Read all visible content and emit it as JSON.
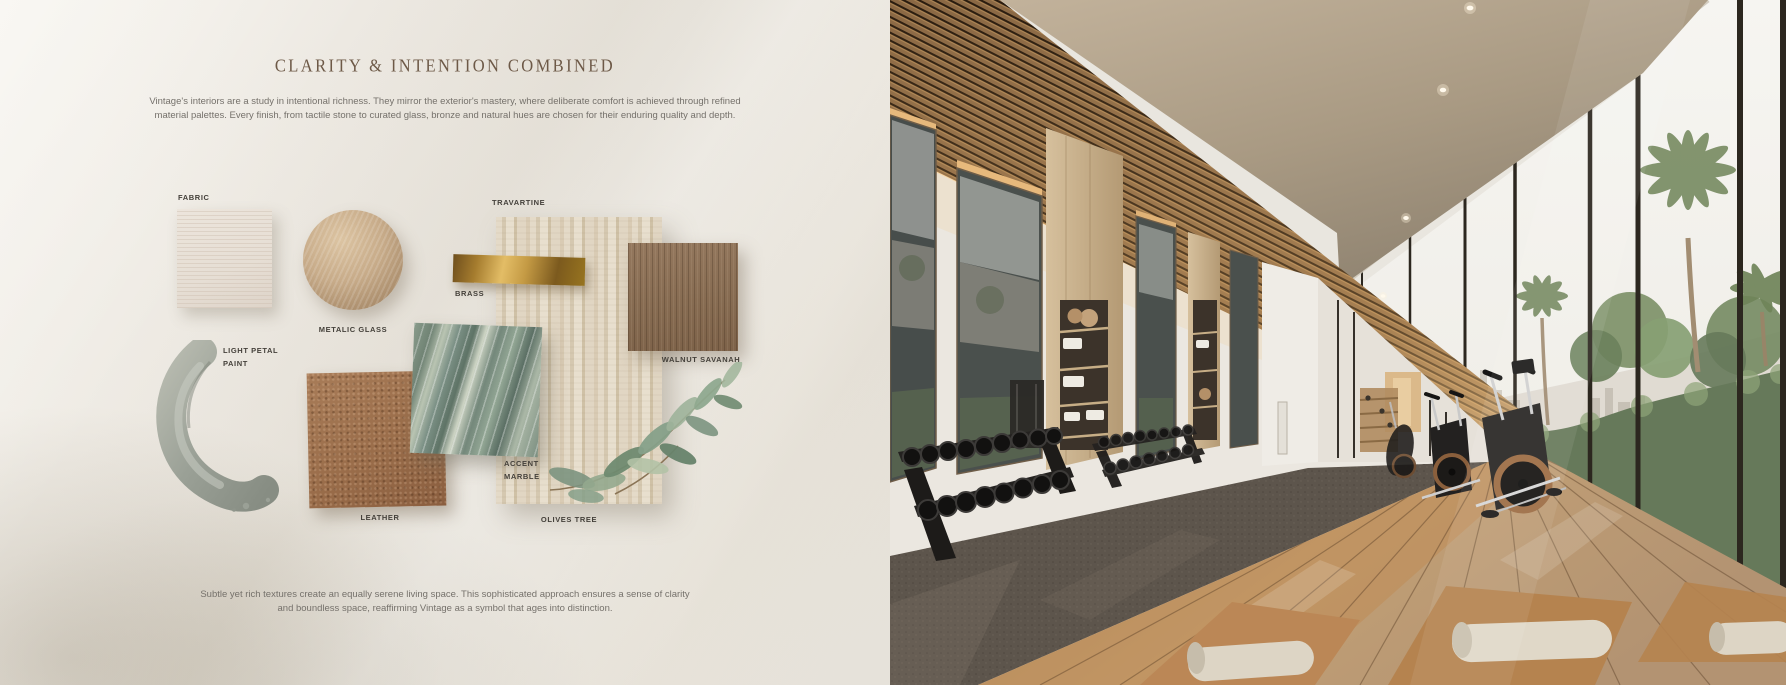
{
  "board": {
    "title": "CLARITY & INTENTION COMBINED",
    "intro": "Vintage's interiors are a study in intentional richness. They mirror the exterior's mastery, where deliberate comfort is achieved through refined material palettes. Every finish, from tactile stone to curated glass, bronze and natural hues are chosen for their enduring quality and depth.",
    "outro": "Subtle yet rich textures create an equally serene living space. This sophisticated approach ensures a sense of clarity and boundless space, reaffirming Vintage as a symbol that ages into distinction.",
    "labels": {
      "fabric": "FABRIC",
      "metalic_glass": "METALIC GLASS",
      "travartine": "TRAVARTINE",
      "brass": "BRASS",
      "walnut_savanah": "WALNUT SAVANAH",
      "light_petal_line1": "LIGHT PETAL",
      "light_petal_line2": "PAINT",
      "leather": "LEATHER",
      "accent_line1": "ACCENT",
      "accent_line2": "MARBLE",
      "olives_tree": "OLIVES TREE"
    }
  },
  "photo": {
    "subject": "gym corridor interior rendering"
  },
  "colors": {
    "page_bg": "#eae6df",
    "title_text": "#6d5947",
    "body_text": "#75716b",
    "label_text": "#44403a",
    "fabric": "#e8e1d8",
    "metalic_glass": "#c7ab89",
    "travertine": "#ddd1bd",
    "brass": "#c49a44",
    "walnut": "#876c52",
    "leather": "#9a6d4a",
    "accent_marble": "#7d9287",
    "light_petal_paint": "#9aa096",
    "olive_leaf": "#8fa98f",
    "ceiling_wood": "#8a6844",
    "ceiling_plaster": "#a89a84",
    "rubber_floor": "#5d554c",
    "deck_wood": "#b98d5e",
    "hedge_green": "#66795a"
  }
}
